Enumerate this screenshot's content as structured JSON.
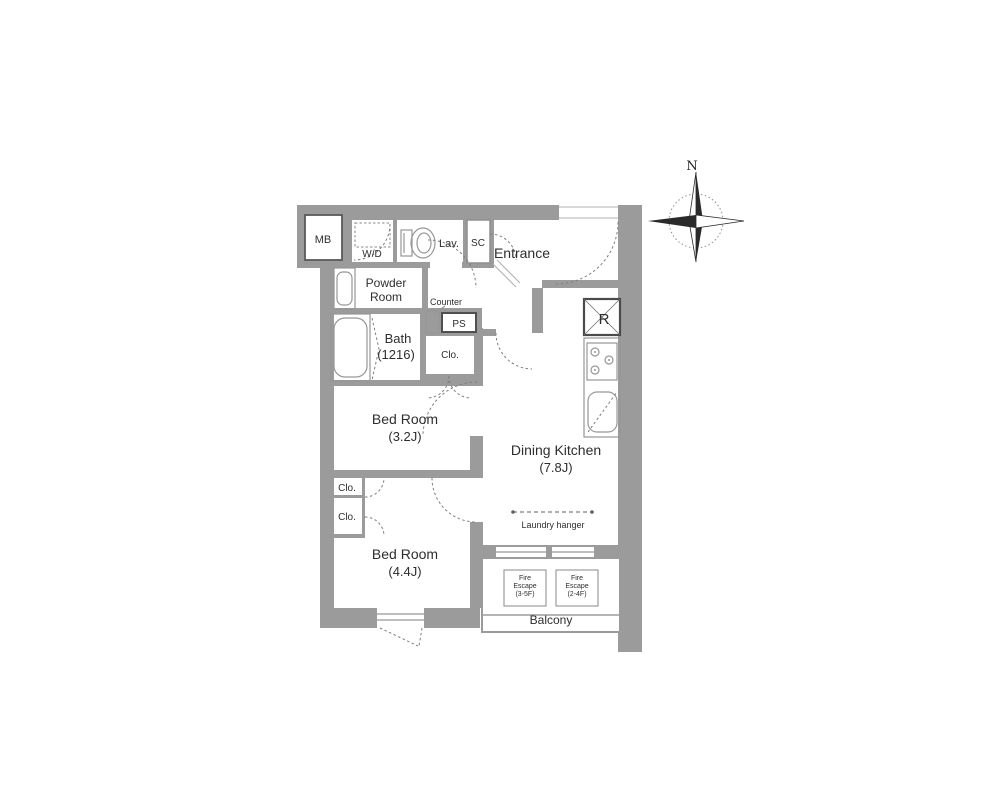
{
  "colors": {
    "wall": "#9b9b9b",
    "thin_line": "#979797",
    "dashed_line": "#7d7d7d",
    "dark_border": "#4f4f4f",
    "text": "#2e2e2e",
    "background": "#ffffff"
  },
  "labels": {
    "mb": "MB",
    "wd": "W/D",
    "lav": "Lav.",
    "sc": "SC",
    "entrance": "Entrance",
    "powder_room": [
      "Powder",
      "Room"
    ],
    "counter": "Counter",
    "ps": "PS",
    "bath": [
      "Bath",
      "(1216)"
    ],
    "closet_hall": "Clo.",
    "bedroom_1": [
      "Bed Room",
      "(3.2J)"
    ],
    "dining_kitchen": [
      "Dining Kitchen",
      "(7.8J)"
    ],
    "refrigerator": "R",
    "laundry_hanger": "Laundry hanger",
    "bedroom_2": [
      "Bed Room",
      "(4.4J)"
    ],
    "closet_2a": "Clo.",
    "closet_2b": "Clo.",
    "fire_escape_1": [
      "Fire",
      "Escape",
      "(3-5F)"
    ],
    "fire_escape_2": [
      "Fire",
      "Escape",
      "(2-4F)"
    ],
    "balcony": "Balcony",
    "compass_north": "N"
  }
}
